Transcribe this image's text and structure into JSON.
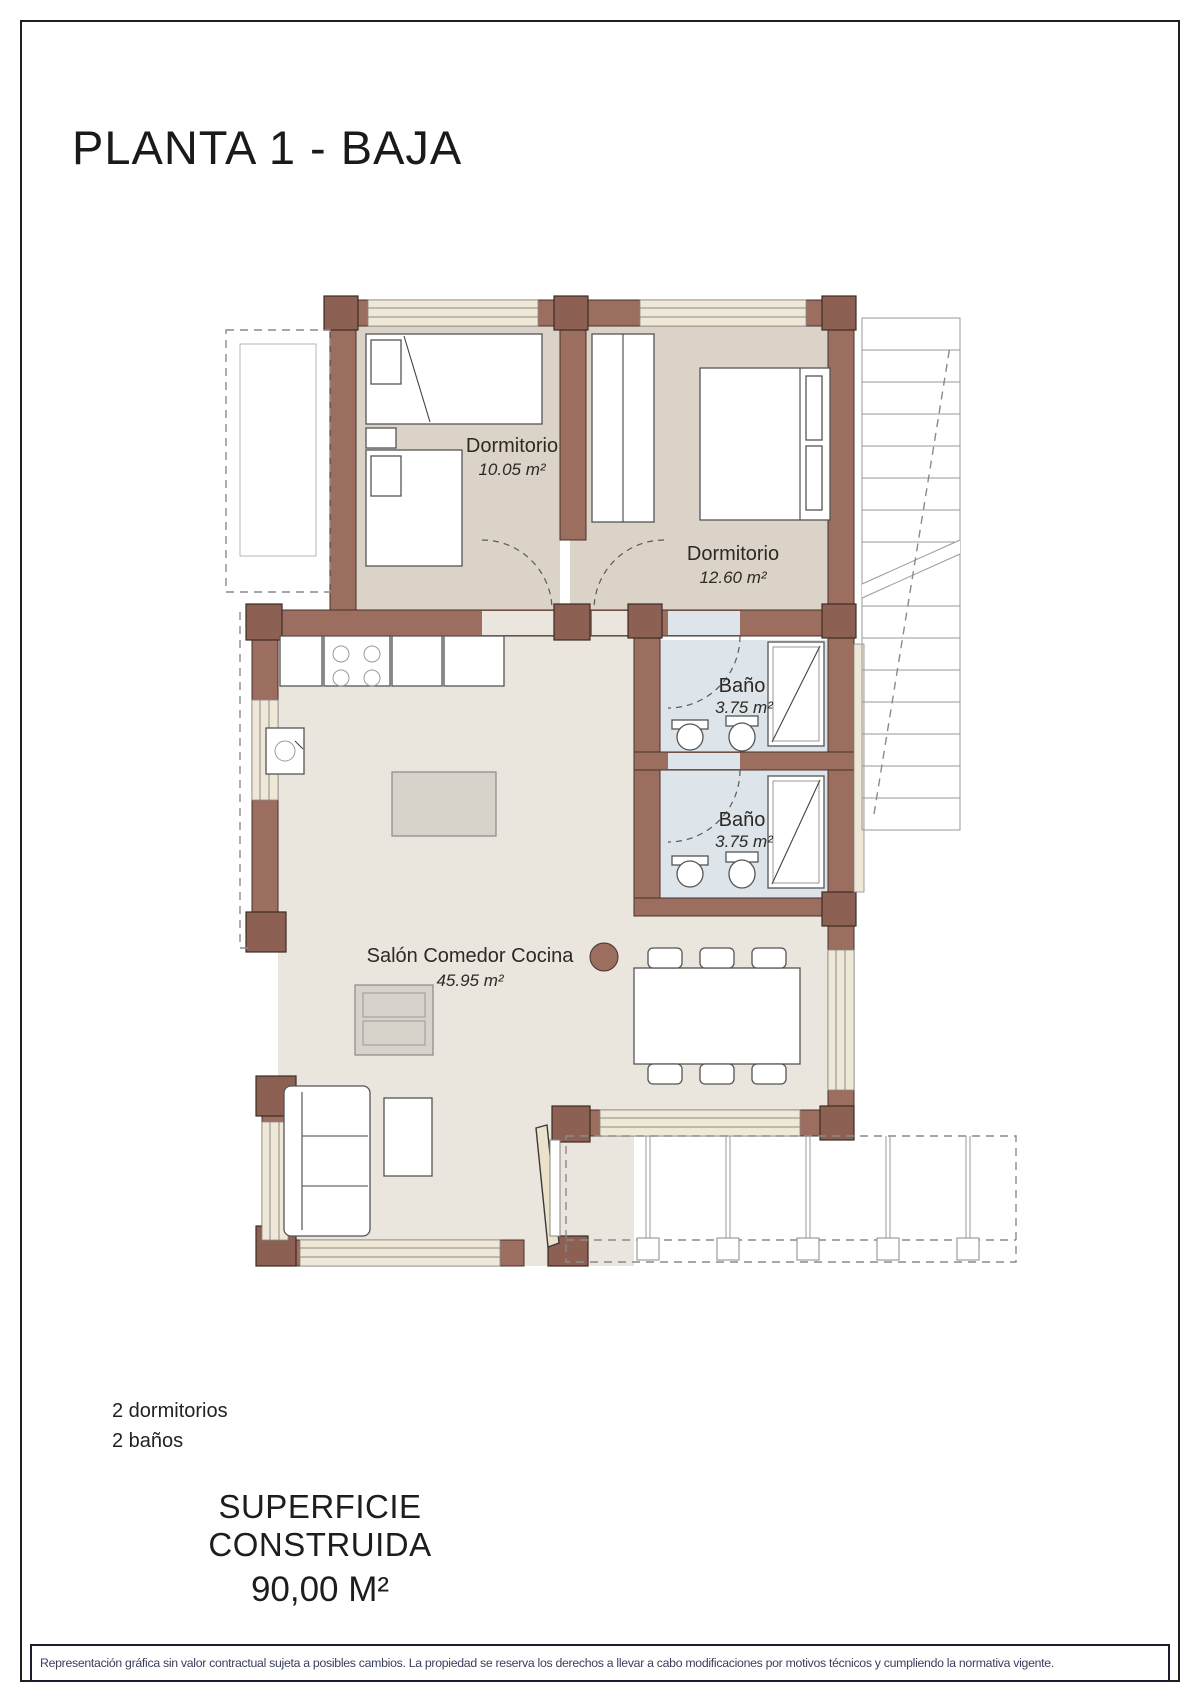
{
  "title": "PLANTA 1 - BAJA",
  "rooms": {
    "dormitorio1": {
      "name": "Dormitorio",
      "area": "10.05 m²"
    },
    "dormitorio2": {
      "name": "Dormitorio",
      "area": "12.60 m²"
    },
    "bano1": {
      "name": "Baño",
      "area": "3.75 m²"
    },
    "bano2": {
      "name": "Baño",
      "area": "3.75 m²"
    },
    "salon": {
      "name": "Salón Comedor Cocina",
      "area": "45.95 m²"
    }
  },
  "summary": {
    "line1": "2 dormitorios",
    "line2": "2 baños"
  },
  "footer": {
    "surface_label": "SUPERFICIE CONSTRUIDA",
    "surface_value": "90,00 M²"
  },
  "disclaimer": "Representación gráfica sin valor contractual sujeta a posibles cambios. La propiedad se reserva los derechos a llevar a cabo modificaciones por motivos técnicos y cumpliendo la normativa vigente.",
  "colors": {
    "wall": "#9b6e60",
    "wallDark": "#8c6052",
    "bedroomFloor": "#dbd2c8",
    "salonFloor": "#eae5dd",
    "bathFloor": "#dde4ea",
    "sill": "#f0e8d6",
    "ink": "#1a1a1a",
    "disclaimerInk": "#3a3f5c"
  }
}
